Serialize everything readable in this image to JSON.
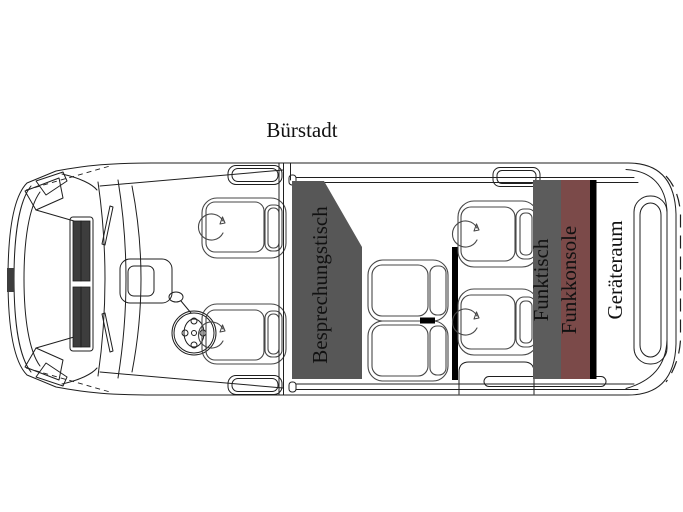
{
  "title": "Bürstadt",
  "floorplan": {
    "labels": {
      "meeting_table": "Besprechungstisch",
      "radio_table": "Funktisch",
      "radio_console": "Funkkonsole",
      "equipment_room": "Geräteraum"
    },
    "colors": {
      "table_gray": "#575757",
      "radio_table_gray": "#5c5c5c",
      "console_red": "#7b4a49",
      "partition_black": "#000000",
      "grille_dark": "#3d3d3d",
      "line": "#1f1f1f",
      "label_text": "#111111",
      "background": "#ffffff"
    }
  }
}
